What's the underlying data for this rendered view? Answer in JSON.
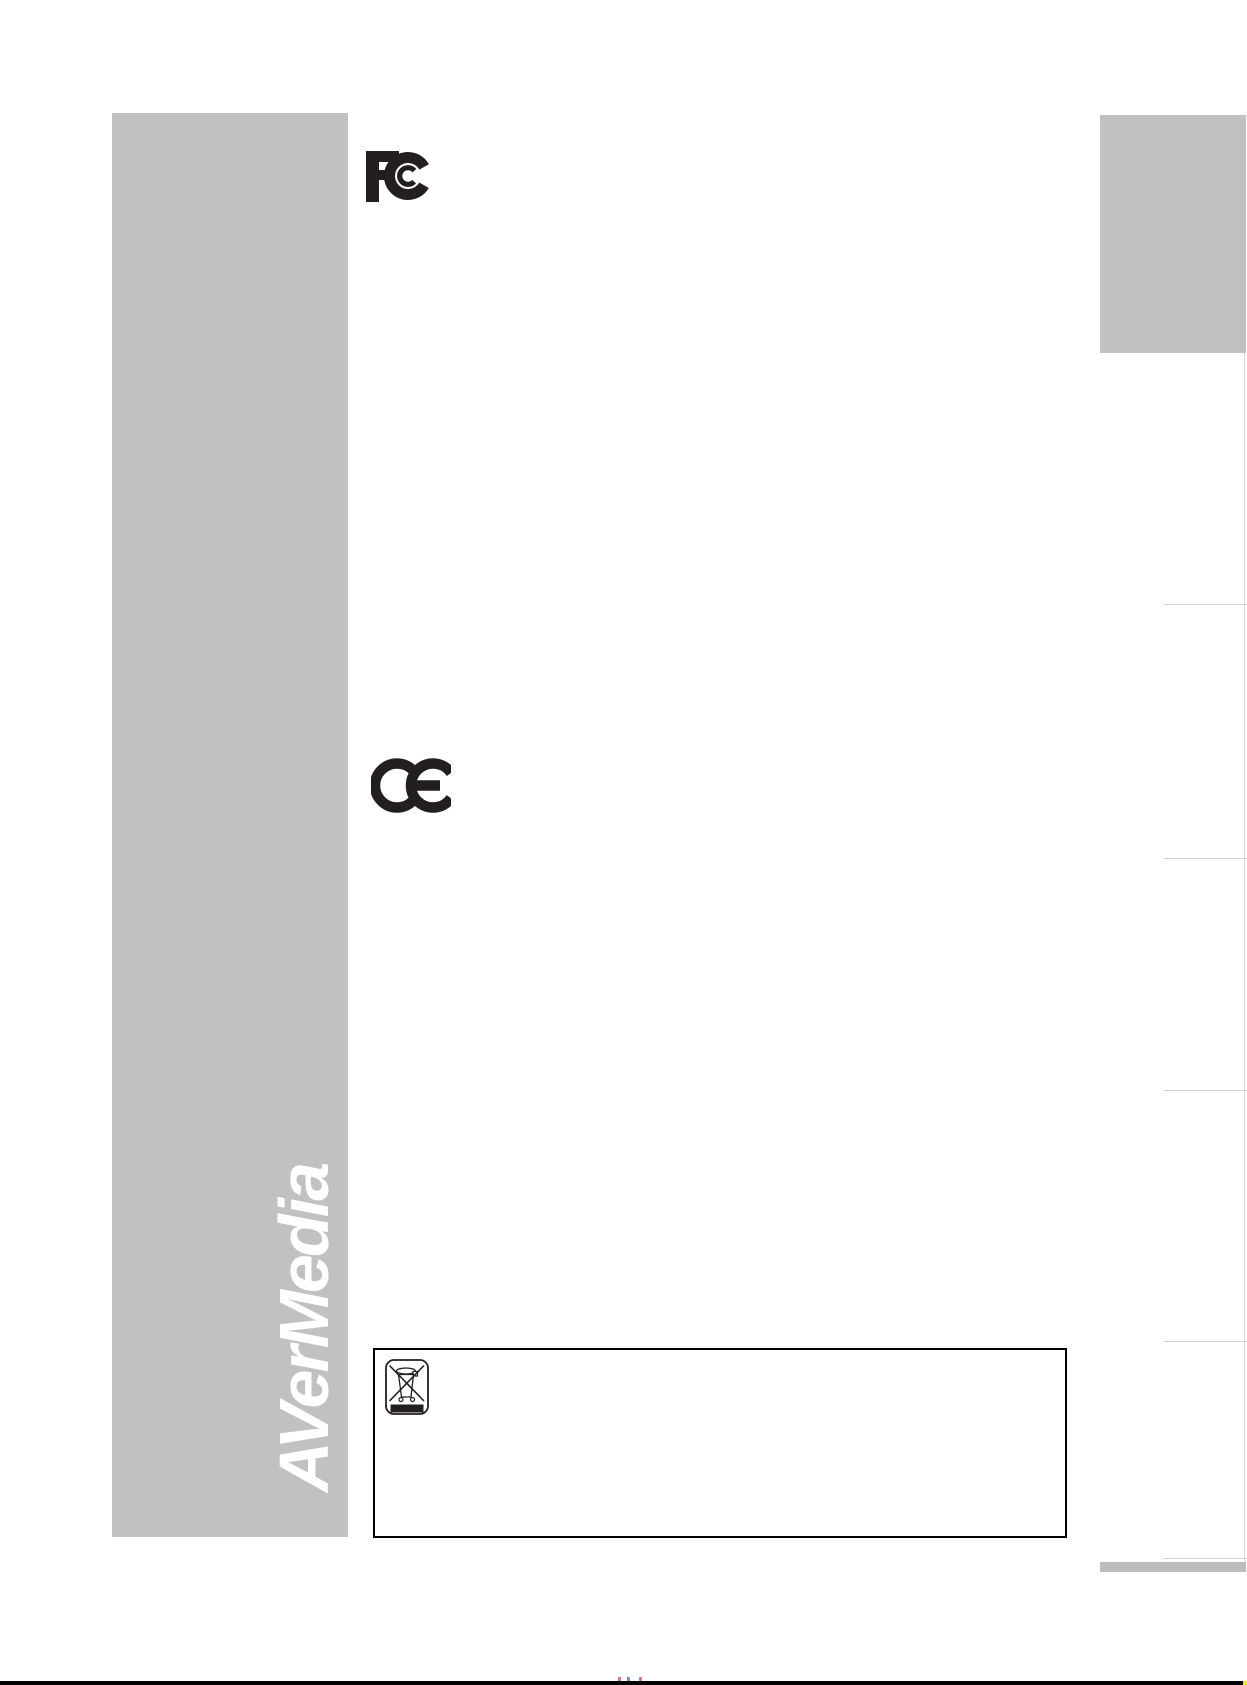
{
  "page": {
    "background_color": "#ffffff",
    "footer_line_color": "#000000"
  },
  "sidebar": {
    "logo_text": "AVerMedia",
    "bg_color": "#c1c1c1",
    "logo_color": "#ffffff"
  },
  "marks": {
    "fcc": {
      "label": "FCC compliance mark",
      "color": "#231f20"
    },
    "ce": {
      "label": "CE compliance mark",
      "color": "#231f20"
    },
    "weee": {
      "label": "WEEE crossed-out wheeled bin symbol",
      "color": "#231f20"
    }
  },
  "right_rail": {
    "tab_color": "#c1c1c1",
    "bottom_bar_color": "#bdbdbd",
    "divider_color": "#d4d4d4",
    "divider_count": 5
  }
}
